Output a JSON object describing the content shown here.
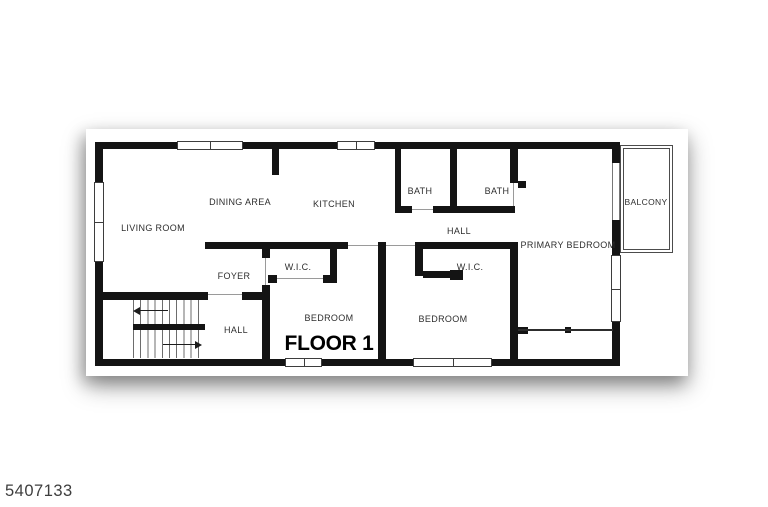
{
  "watermark": "5407133",
  "floor": {
    "title": "FLOOR 1",
    "rooms": {
      "living_room": "LIVING ROOM",
      "dining_area": "DINING AREA",
      "kitchen": "KITCHEN",
      "bath_1": "BATH",
      "bath_2": "BATH",
      "hall_upper": "HALL",
      "primary_bedroom": "PRIMARY BEDROOM",
      "balcony": "BALCONY",
      "foyer": "FOYER",
      "wic_1": "W.I.C.",
      "wic_2": "W.I.C.",
      "bedroom_1": "BEDROOM",
      "bedroom_2": "BEDROOM",
      "hall_lower": "HALL"
    },
    "colors": {
      "wall": "#141414",
      "paper": "#ffffff",
      "label": "#2e2e2e",
      "door_line": "#9a9a9a"
    }
  }
}
